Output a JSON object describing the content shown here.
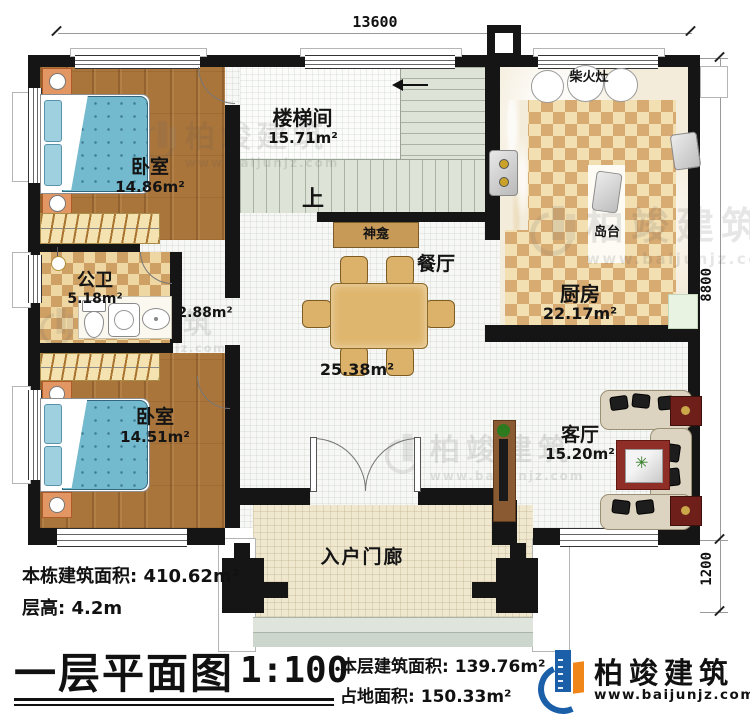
{
  "dimensions": {
    "width": "13600",
    "height_main": "8800",
    "height_porch": "1200"
  },
  "rooms": {
    "bedroom1": {
      "name": "卧室",
      "area": "14.86m²"
    },
    "bathroom": {
      "name": "公卫",
      "area": "5.18m²"
    },
    "hall": {
      "area": "2.88m²"
    },
    "bedroom2": {
      "name": "卧室",
      "area": "14.51m²"
    },
    "stairwell": {
      "name": "楼梯间",
      "area": "15.71m²",
      "up": "上"
    },
    "shrine": {
      "name": "神龛"
    },
    "dining": {
      "name": "餐厅",
      "area": "25.38m²"
    },
    "kitchen": {
      "name": "厨房",
      "area": "22.17m²",
      "stove": "柴火灶",
      "island": "岛台"
    },
    "living": {
      "name": "客厅",
      "area": "15.20m²"
    },
    "porch": {
      "name": "入户门廊"
    }
  },
  "info": {
    "total_area_label": "本栋建筑面积:",
    "total_area": "410.62m²",
    "floor_height_label": "层高:",
    "floor_height": "4.2m"
  },
  "title_block": {
    "title": "一层平面图",
    "scale": "1:100",
    "floor_area_label": "本层建筑面积:",
    "floor_area": "139.76m²",
    "footprint_label": "占地面积:",
    "footprint": "150.33m²"
  },
  "brand": {
    "name": "柏竣建筑",
    "url": "www.baijunjz.com"
  },
  "watermark": {
    "name": "柏竣建筑",
    "url": "www.baijunjz.com"
  },
  "colors": {
    "brand_blue": "#1a5fa8",
    "brand_orange": "#f08519",
    "wall": "#151515"
  }
}
